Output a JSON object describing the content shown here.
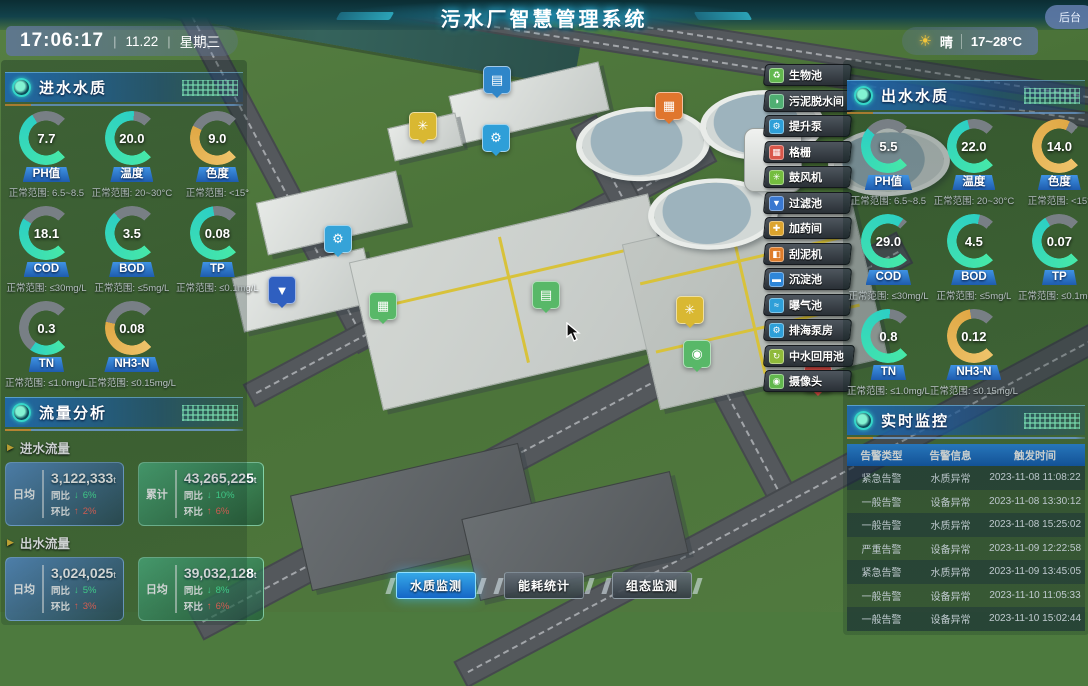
{
  "header": {
    "title": "污水厂智慧管理系统",
    "time": "17:06:17",
    "date": "11.22",
    "weekday": "星期三",
    "weather_icon": "sun",
    "weather": "晴",
    "temp_range": "17~28°C",
    "backend_label": "后台"
  },
  "left": {
    "water_quality": {
      "title": "进水水质",
      "gauges": [
        {
          "label": "PH值",
          "value": "7.7",
          "range": "正常范围: 6.5~8.5",
          "percent": 72,
          "tone": "teal"
        },
        {
          "label": "温度",
          "value": "20.0",
          "range": "正常范围: 20~30°C",
          "percent": 85,
          "tone": "teal"
        },
        {
          "label": "色度",
          "value": "9.0",
          "range": "正常范围: <15°",
          "percent": 60,
          "tone": "amber"
        },
        {
          "label": "COD",
          "value": "18.1",
          "range": "正常范围: ≤30mg/L",
          "percent": 62,
          "tone": "teal"
        },
        {
          "label": "BOD",
          "value": "3.5",
          "range": "正常范围: ≤5mg/L",
          "percent": 68,
          "tone": "teal"
        },
        {
          "label": "TP",
          "value": "0.08",
          "range": "正常范围: ≤0.1mg/L",
          "percent": 80,
          "tone": "teal"
        },
        {
          "label": "TN",
          "value": "0.3",
          "range": "正常范围: ≤1.0mg/L",
          "percent": 30,
          "tone": "teal"
        },
        {
          "label": "NH3-N",
          "value": "0.08",
          "range": "正常范围: ≤0.15mg/L",
          "percent": 55,
          "tone": "amber"
        }
      ]
    },
    "flow": {
      "title": "流量分析",
      "groups": [
        {
          "name": "进水流量",
          "cards": [
            {
              "style": "blue",
              "tag": "日均",
              "value": "3,122,333",
              "unit": "t",
              "rows": [
                {
                  "k": "同比",
                  "dir": "down",
                  "arrow": "↓",
                  "v": "6%"
                },
                {
                  "k": "环比",
                  "dir": "up",
                  "arrow": "↑",
                  "v": "2%"
                }
              ]
            },
            {
              "style": "green",
              "tag": "累计",
              "value": "43,265,225",
              "unit": "t",
              "rows": [
                {
                  "k": "同比",
                  "dir": "down",
                  "arrow": "↓",
                  "v": "10%"
                },
                {
                  "k": "环比",
                  "dir": "up",
                  "arrow": "↑",
                  "v": "6%"
                }
              ]
            }
          ]
        },
        {
          "name": "出水流量",
          "cards": [
            {
              "style": "blue",
              "tag": "日均",
              "value": "3,024,025",
              "unit": "t",
              "rows": [
                {
                  "k": "同比",
                  "dir": "down",
                  "arrow": "↓",
                  "v": "5%"
                },
                {
                  "k": "环比",
                  "dir": "up",
                  "arrow": "↑",
                  "v": "3%"
                }
              ]
            },
            {
              "style": "green",
              "tag": "日均",
              "value": "39,032,128",
              "unit": "t",
              "rows": [
                {
                  "k": "同比",
                  "dir": "down",
                  "arrow": "↓",
                  "v": "8%"
                },
                {
                  "k": "环比",
                  "dir": "up",
                  "arrow": "↑",
                  "v": "6%"
                }
              ]
            }
          ]
        }
      ]
    }
  },
  "right": {
    "water_quality": {
      "title": "出水水质",
      "gauges": [
        {
          "label": "PH值",
          "value": "5.5",
          "range": "正常范围: 6.5~8.5",
          "percent": 65,
          "tone": "teal"
        },
        {
          "label": "温度",
          "value": "22.0",
          "range": "正常范围: 20~30°C",
          "percent": 78,
          "tone": "teal"
        },
        {
          "label": "色度",
          "value": "14.0",
          "range": "正常范围: <15°",
          "percent": 92,
          "tone": "amber"
        },
        {
          "label": "COD",
          "value": "29.0",
          "range": "正常范围: ≤30mg/L",
          "percent": 96,
          "tone": "teal"
        },
        {
          "label": "BOD",
          "value": "4.5",
          "range": "正常范围: ≤5mg/L",
          "percent": 88,
          "tone": "teal"
        },
        {
          "label": "TP",
          "value": "0.07",
          "range": "正常范围: ≤0.1mg/L",
          "percent": 72,
          "tone": "teal"
        },
        {
          "label": "TN",
          "value": "0.8",
          "range": "正常范围: ≤1.0mg/L",
          "percent": 85,
          "tone": "teal"
        },
        {
          "label": "NH3-N",
          "value": "0.12",
          "range": "正常范围: ≤0.15mg/L",
          "percent": 80,
          "tone": "amber"
        }
      ]
    },
    "monitor": {
      "title": "实时监控",
      "columns": [
        "告警类型",
        "告警信息",
        "触发时间"
      ],
      "rows": [
        [
          "紧急告警",
          "水质异常",
          "2023-11-08 11:08:22"
        ],
        [
          "一般告警",
          "设备异常",
          "2023-11-08 13:30:12"
        ],
        [
          "一般告警",
          "水质异常",
          "2023-11-08 15:25:02"
        ],
        [
          "严重告警",
          "设备异常",
          "2023-11-09 12:22:58"
        ],
        [
          "紧急告警",
          "水质异常",
          "2023-11-09 13:45:05"
        ],
        [
          "一般告警",
          "设备异常",
          "2023-11-10 11:05:33"
        ],
        [
          "一般告警",
          "设备异常",
          "2023-11-10 15:02:44"
        ]
      ]
    }
  },
  "facility_buttons": [
    {
      "label": "生物池",
      "color": "#62b84e",
      "glyph": "♻",
      "icon": "bio-pool-icon"
    },
    {
      "label": "污泥脱水间",
      "color": "#4fae72",
      "glyph": "◑",
      "icon": "sludge-dewatering-icon"
    },
    {
      "label": "提升泵",
      "color": "#2e9fd8",
      "glyph": "⚙",
      "icon": "lift-pump-icon"
    },
    {
      "label": "格栅",
      "color": "#d8574a",
      "glyph": "▦",
      "icon": "grille-icon"
    },
    {
      "label": "鼓风机",
      "color": "#74bd3f",
      "glyph": "✳",
      "icon": "blower-icon"
    },
    {
      "label": "过滤池",
      "color": "#3a78d0",
      "glyph": "▼",
      "icon": "filter-pool-icon"
    },
    {
      "label": "加药间",
      "color": "#dca42e",
      "glyph": "✚",
      "icon": "dosing-room-icon"
    },
    {
      "label": "刮泥机",
      "color": "#de7c2a",
      "glyph": "◧",
      "icon": "mud-scraper-icon"
    },
    {
      "label": "沉淀池",
      "color": "#2e86d8",
      "glyph": "▬",
      "icon": "sedimentation-pool-icon"
    },
    {
      "label": "曝气池",
      "color": "#2e9fd8",
      "glyph": "≈",
      "icon": "aeration-pool-icon"
    },
    {
      "label": "排海泵房",
      "color": "#2e9fd8",
      "glyph": "⚙",
      "icon": "sea-pump-house-icon"
    },
    {
      "label": "中水回用池",
      "color": "#8fba3a",
      "glyph": "↻",
      "icon": "water-reuse-pool-icon"
    },
    {
      "label": "摄像头",
      "color": "#62b84e",
      "glyph": "◉",
      "icon": "camera-icon"
    }
  ],
  "map_markers": [
    {
      "name": "sedimentation-tank-marker",
      "color": "#2f86c9",
      "glyph": "▤",
      "x": 483,
      "y": 66
    },
    {
      "name": "blower-marker",
      "color": "#d9b832",
      "glyph": "✳",
      "x": 409,
      "y": 112
    },
    {
      "name": "lift-pump-marker",
      "color": "#2f9fd8",
      "glyph": "⚙",
      "x": 482,
      "y": 124
    },
    {
      "name": "scraper-marker",
      "color": "#e0762e",
      "glyph": "▦",
      "x": 655,
      "y": 92
    },
    {
      "name": "pump-marker",
      "color": "#35a3d8",
      "glyph": "⚙",
      "x": 324,
      "y": 225
    },
    {
      "name": "filter-tank-marker",
      "color": "#2f5fc0",
      "glyph": "▼",
      "x": 268,
      "y": 276
    },
    {
      "name": "bio-tank-marker",
      "color": "#58b868",
      "glyph": "▦",
      "x": 369,
      "y": 292
    },
    {
      "name": "bio-tank-marker-2",
      "color": "#58b868",
      "glyph": "▤",
      "x": 532,
      "y": 281
    },
    {
      "name": "blower-marker-2",
      "color": "#d9b832",
      "glyph": "✳",
      "x": 676,
      "y": 296
    },
    {
      "name": "camera-marker",
      "color": "#58b868",
      "glyph": "◉",
      "x": 683,
      "y": 340
    },
    {
      "name": "grille-marker",
      "color": "#d84b44",
      "glyph": "▦",
      "x": 804,
      "y": 364
    }
  ],
  "bottom_tabs": [
    {
      "label": "水质监测",
      "active": true
    },
    {
      "label": "能耗统计",
      "active": false
    },
    {
      "label": "组态监测",
      "active": false
    }
  ],
  "colors": {
    "gauge_teal_1": "#46e8a8",
    "gauge_teal_2": "#2ccfc4",
    "gauge_amber_1": "#eec36a",
    "gauge_amber_2": "#e0a845",
    "gauge_track": "#787f85",
    "header_blue": "#1f7ad0",
    "accent_orange": "#e8a13a"
  }
}
